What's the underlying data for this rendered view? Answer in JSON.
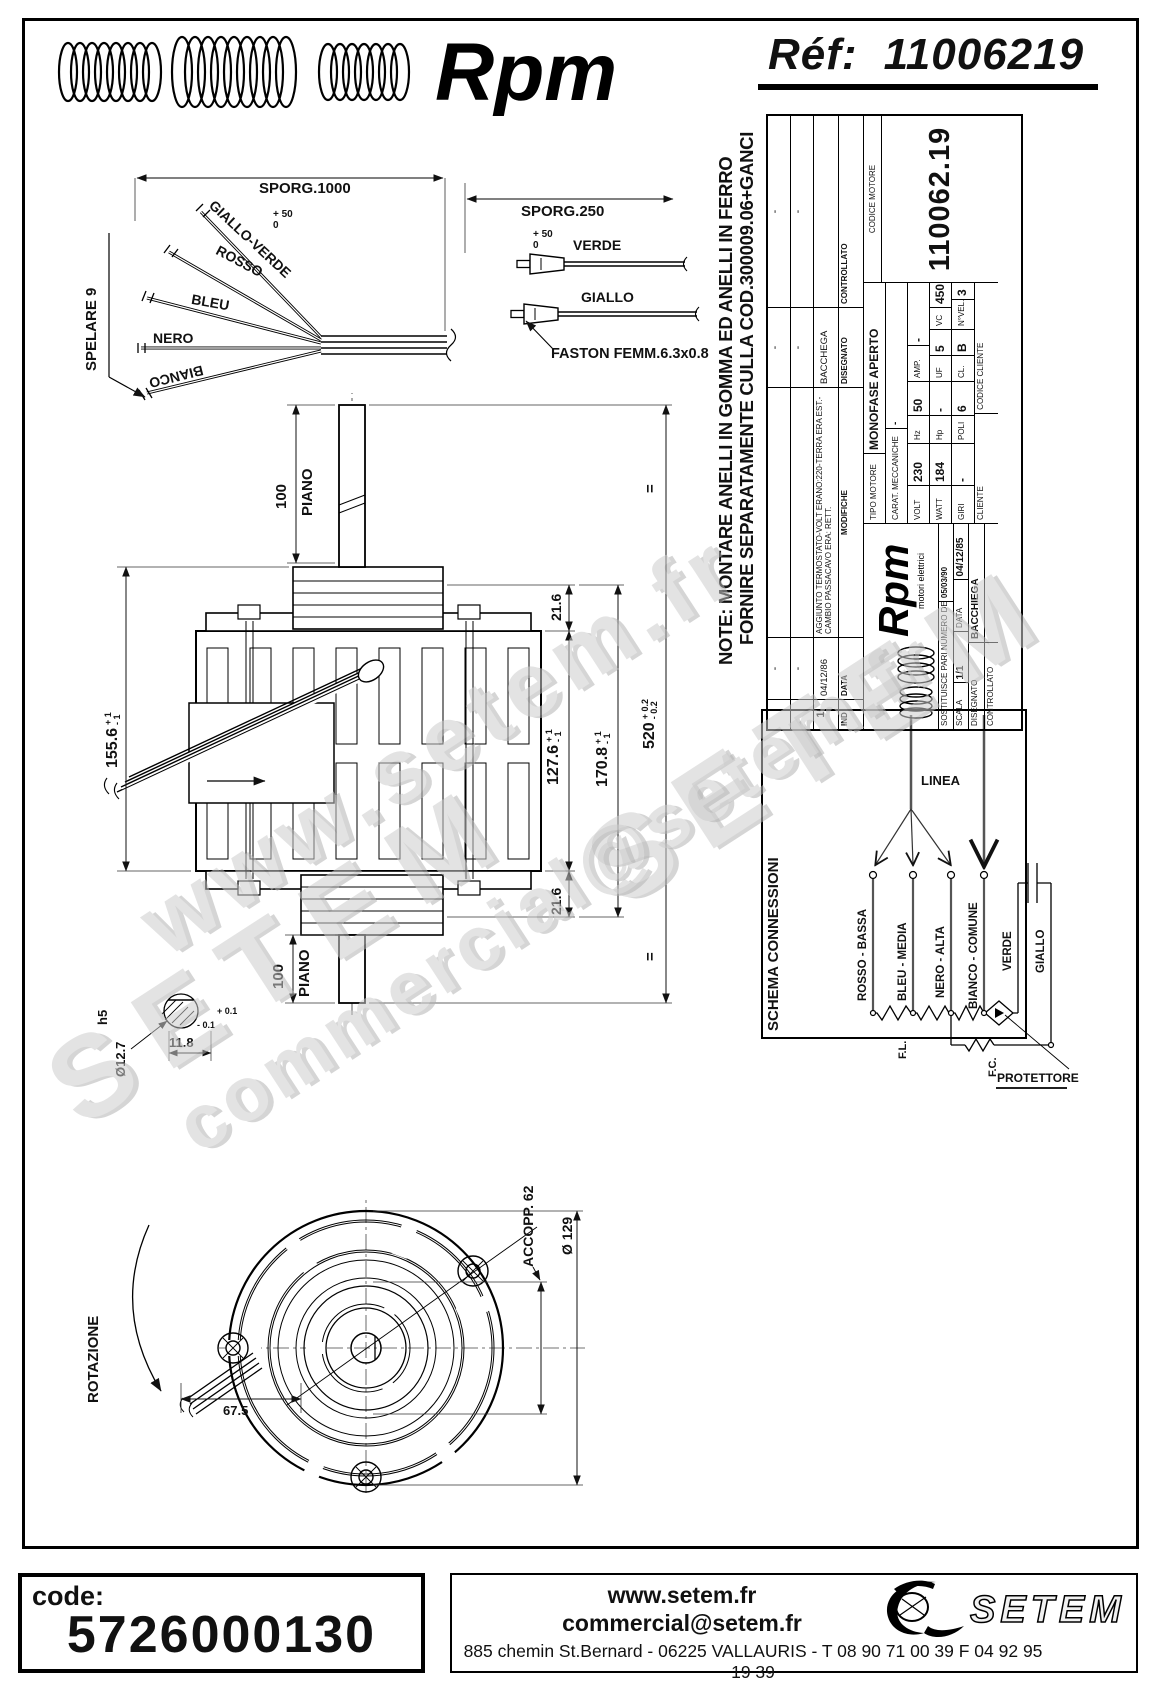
{
  "header": {
    "brand": "Rpm",
    "ref_label": "Réf:",
    "ref_value": "11006219"
  },
  "note": {
    "line1": "NOTE: MONTARE ANELLI IN GOMMA ED ANELLI IN FERRO",
    "line2": "FORNIRE SEPARATAMENTE CULLA COD.300009.06+GANCI"
  },
  "splay": {
    "spelare": "SPELARE 9",
    "nero": "NERO",
    "bleu": "BLEU",
    "rosso": "ROSSO",
    "gialloverde": "GIALLO-VERDE",
    "bianco": "BIANCO",
    "sporg": "SPORG.1000",
    "tp": "+ 50",
    "tm": "0"
  },
  "faston": {
    "sporg": "SPORG.250",
    "tp": "+ 50",
    "tm": "0",
    "verde": "VERDE",
    "giallo": "GIALLO",
    "label": "FASTON FEMM.6.3x0.8"
  },
  "motor": {
    "d155": "155.6",
    "d155p": "+ 1",
    "d155m": "- 1",
    "d127": "127.6",
    "d127p": "+ 1",
    "d127m": "- 1",
    "d170": "170.8",
    "d170p": "+ 1",
    "d170m": "- 1",
    "d520": "520",
    "d520p": "+ 0.2",
    "d520m": "- 0.2",
    "d216a": "21.6",
    "d216b": "21.6",
    "p100a": "100",
    "pianoa": "PIANO",
    "p100b": "100",
    "pianob": "PIANO",
    "eq": "=",
    "h5": "h5",
    "d127mm": "Ø12.7",
    "d118": "11.8",
    "d118p": "+ 0.1",
    "d118m": "- 0.1"
  },
  "fan": {
    "rotazione": "ROTAZIONE",
    "accopp": "ACCOPP. 62",
    "diam": "Ø 129",
    "d675": "67.5"
  },
  "schema": {
    "title": "SCHEMA CONNESSIONI",
    "linea": "LINEA",
    "t1": "ROSSO - BASSA",
    "t2": "BLEU - MEDIA",
    "t3": "NERO - ALTA",
    "t4": "BIANCO - COMUNE",
    "verde": "VERDE",
    "giallo": "GIALLO",
    "fl": "F.L.",
    "fc": "F.C.",
    "prot": "PROTETTORE"
  },
  "titleblock": {
    "rev": {
      "dash": "-",
      "ind_label": "IND",
      "data_label": "DATA",
      "mod_label": "MODIFICHE",
      "ind": "1",
      "data": "04/12/86",
      "mod": "AGGIUNTO TERMOSTATO-VOLT ERANO:220-TERRA ERA EST.-CAMBIO PASSACAVO ERA: RETT.",
      "firma": "BACCHEGA",
      "disegnato": "DISEGNATO",
      "controllato": "CONTROLLATO"
    },
    "logo": {
      "brand": "Rpm",
      "sub": "motori elettrici"
    },
    "sost_label": "SOSTITUISCE PARI NUMERO DEL",
    "sost": "05/03/90",
    "scala_label": "SCALA",
    "scala": "1/1",
    "data_label": "DATA",
    "data": "04/12/85",
    "disegnato_label": "DISEGNATO",
    "disegnato": "BACCHIEGA",
    "controllato_label": "CONTROLLATO",
    "controllato": "",
    "tipo_label": "TIPO MOTORE",
    "tipo": "MONOFASE APERTO",
    "carat_label": "CARAT. MECCANICHE",
    "carat": "-",
    "volt_label": "VOLT",
    "volt": "230",
    "hz_label": "Hz",
    "hz": "50",
    "amp_label": "AMP.",
    "amp": "-",
    "watt_label": "WATT",
    "watt": "184",
    "hp_label": "Hp",
    "hp": "-",
    "uf_label": "UF",
    "uf": "5",
    "vc_label": "VC",
    "vc": "450",
    "giri_label": "GIRI",
    "giri": "-",
    "poli_label": "POLI",
    "poli": "6",
    "cl_label": "CL.",
    "cl": "B",
    "nvel_label": "N°VEL.",
    "nvel": "3",
    "cliente_label": "CLIENTE",
    "codcli_label": "CODICE CLIENTE",
    "codmot_label": "CODICE MOTORE",
    "codmot": "110062.19"
  },
  "watermarks": {
    "w1": "www.setem.fr",
    "w2": "SETEM",
    "w3": "SETEM",
    "w4": "commercial@setem.fr"
  },
  "footer": {
    "code_label": "code:",
    "code_value": "5726000130",
    "site": "www.setem.fr",
    "email": "commercial@setem.fr",
    "address": "885 chemin St.Bernard  -  06225 VALLAURIS  -  T 08 90 71 00 39   F 04 92 95 19 39",
    "logo_text": "SETEM"
  }
}
